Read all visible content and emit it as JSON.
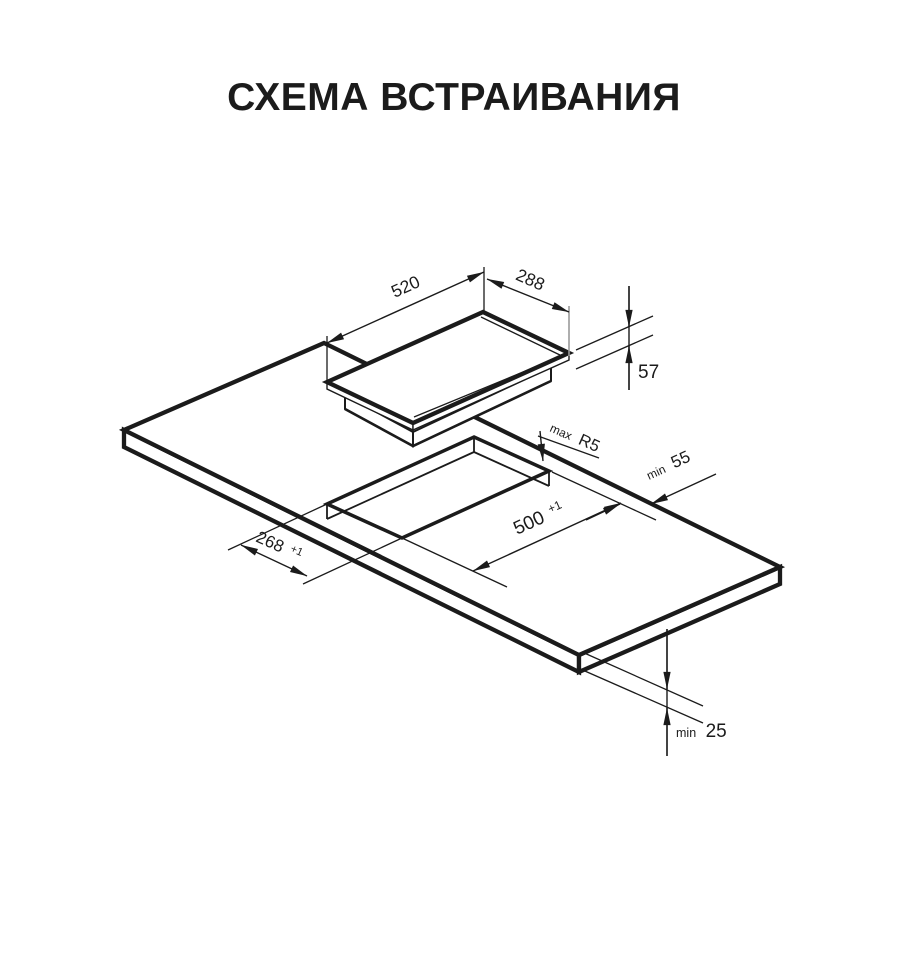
{
  "title": "СХЕМА ВСТРАИВАНИЯ",
  "colors": {
    "ink": "#1b1b1b",
    "muted_line": "#9a9a9a",
    "background": "#ffffff"
  },
  "appliance_dimensions": {
    "width": "520",
    "depth": "288",
    "height": "57"
  },
  "cutout_dimensions": {
    "length": "500",
    "length_tolerance": "+1",
    "width": "268",
    "width_tolerance": "+1",
    "corner_radius_prefix": "max",
    "corner_radius": "R5"
  },
  "clearances": {
    "rear_prefix": "min",
    "rear": "55",
    "bottom_prefix": "min",
    "bottom": "25"
  }
}
